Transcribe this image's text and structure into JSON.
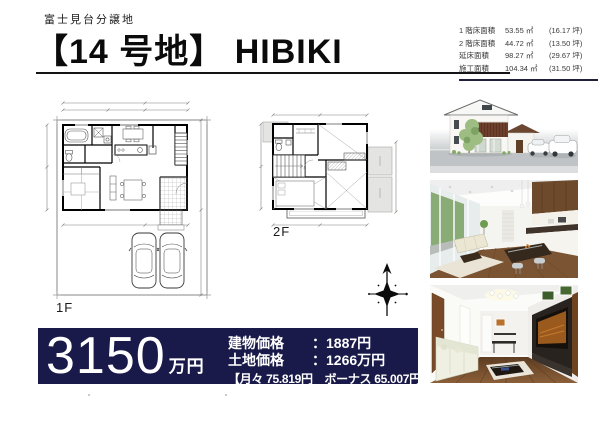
{
  "header": {
    "estate_name": "富士見台分譲地",
    "title": "【14 号地】 HIBIKI"
  },
  "area_table": {
    "rows": [
      {
        "label": "1 階床面積",
        "value": "53.55 ㎡",
        "tsubo": "(16.17 坪)"
      },
      {
        "label": "2 階床面積",
        "value": "44.72 ㎡",
        "tsubo": "(13.50 坪)"
      },
      {
        "label": "延床面積",
        "value": "98.27 ㎡",
        "tsubo": "(29.67 坪)"
      },
      {
        "label": "施工面積",
        "value": "104.34 ㎡",
        "tsubo": "(31.50 坪)"
      }
    ]
  },
  "floorplans": {
    "first_floor_label": "1F",
    "second_floor_label": "2F"
  },
  "price_banner": {
    "amount": "3150",
    "unit": "万円",
    "rows": [
      {
        "label": "建物価格",
        "value": "：1887円"
      },
      {
        "label": "土地価格",
        "value": "：1266万円"
      }
    ],
    "payment_note": "【月々 75.819円　ボーナス 65.007円】",
    "background_color": "#191a49"
  },
  "photos": [
    {
      "name": "exterior-render"
    },
    {
      "name": "ldk-interior-render"
    },
    {
      "name": "living-interior-render"
    }
  ],
  "icons": {
    "compass": "north-compass-icon"
  }
}
